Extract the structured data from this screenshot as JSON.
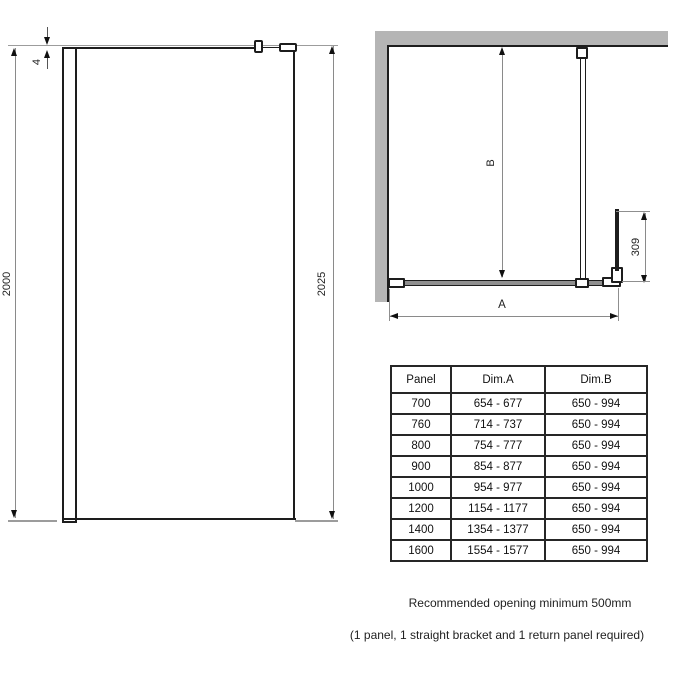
{
  "front_view": {
    "dim_top_offset": "4",
    "dim_height_left": "2000",
    "dim_height_right": "2025"
  },
  "plan_view": {
    "dim_depth_label": "B",
    "dim_width_label": "A",
    "dim_return_panel": "309"
  },
  "table": {
    "headers": [
      "Panel",
      "Dim.A",
      "Dim.B"
    ],
    "rows": [
      {
        "panel": "700",
        "dim_a": "654 - 677",
        "dim_b": "650 - 994"
      },
      {
        "panel": "760",
        "dim_a": "714 - 737",
        "dim_b": "650 - 994"
      },
      {
        "panel": "800",
        "dim_a": "754 - 777",
        "dim_b": "650 - 994"
      },
      {
        "panel": "900",
        "dim_a": "854 - 877",
        "dim_b": "650 - 994"
      },
      {
        "panel": "1000",
        "dim_a": "954 - 977",
        "dim_b": "650 - 994"
      },
      {
        "panel": "1200",
        "dim_a": "1154 - 1177",
        "dim_b": "650 - 994"
      },
      {
        "panel": "1400",
        "dim_a": "1354 - 1377",
        "dim_b": "650 - 994"
      },
      {
        "panel": "1600",
        "dim_a": "1554 - 1577",
        "dim_b": "650 - 994"
      }
    ]
  },
  "notes": {
    "line1": "Recommended opening minimum 500mm",
    "line2": "(1 panel, 1 straight bracket and 1 return panel required)"
  },
  "colors": {
    "background": "#ffffff",
    "drawing_line": "#1d1d1d",
    "dimension_line": "#8a8a8a",
    "wall_fill": "#b5b5b5",
    "panel_fill": "#8f8f8f"
  }
}
